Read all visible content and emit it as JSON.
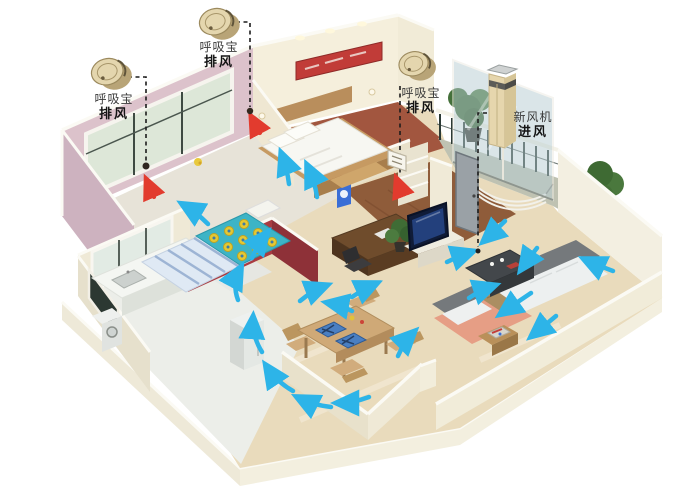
{
  "callouts": [
    {
      "id": "exhaust-1",
      "line1": "呼吸宝",
      "line2": "排风"
    },
    {
      "id": "exhaust-2",
      "line1": "呼吸宝",
      "line2": "排风"
    },
    {
      "id": "exhaust-3",
      "line1": "呼吸宝",
      "line2": "排风"
    },
    {
      "id": "fresh-air",
      "line1": "新风机",
      "line2": "进风"
    }
  ],
  "icons": {
    "exhaust_device": "gold-cylinder-vent-device",
    "fresh_air_unit": "gold-tower-unit",
    "airflow_arrow": "curved-cyan-arrow",
    "exhaust_arrow": "small-red-arrow",
    "vent_point": "dark-ceiling-vent-dot"
  },
  "colors": {
    "airflow_blue": "#2db4e8",
    "exhaust_red": "#e23b2e",
    "device_gold": "#e4d6ae",
    "wall_cream": "#f4eedb",
    "wall_pink": "#dcc2cb",
    "wall_red": "#a93b41",
    "floor_beige": "#e9dbbc",
    "leader_line": "#1c1c1c"
  }
}
